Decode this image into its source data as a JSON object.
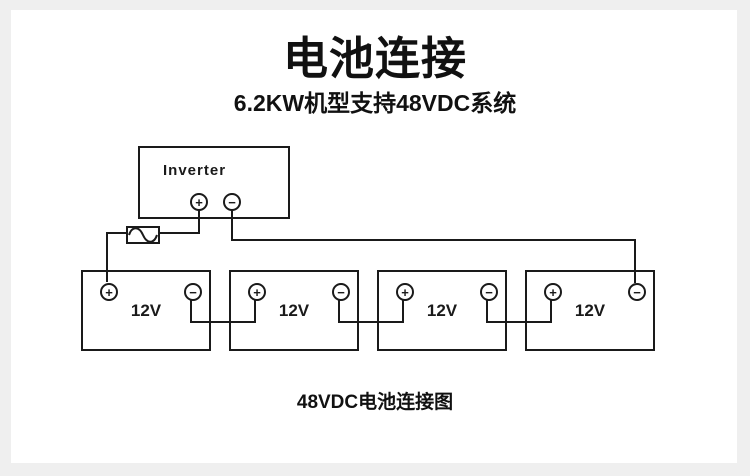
{
  "header": {
    "title": "电池连接",
    "subtitle": "6.2KW机型支持48VDC系统"
  },
  "diagram": {
    "inverter": {
      "label": "Inverter",
      "positive_terminal": "+",
      "negative_terminal": "−"
    },
    "fuse": {
      "symbol": "sine-wave"
    },
    "batteries": [
      {
        "label": "12V",
        "positive_terminal": "+",
        "negative_terminal": "−"
      },
      {
        "label": "12V",
        "positive_terminal": "+",
        "negative_terminal": "−"
      },
      {
        "label": "12V",
        "positive_terminal": "+",
        "negative_terminal": "−"
      },
      {
        "label": "12V",
        "positive_terminal": "+",
        "negative_terminal": "−"
      }
    ],
    "caption": "48VDC电池连接图"
  },
  "colors": {
    "line": "#1a1a1a",
    "text": "#111111",
    "background": "#efefef",
    "canvas": "#ffffff"
  }
}
